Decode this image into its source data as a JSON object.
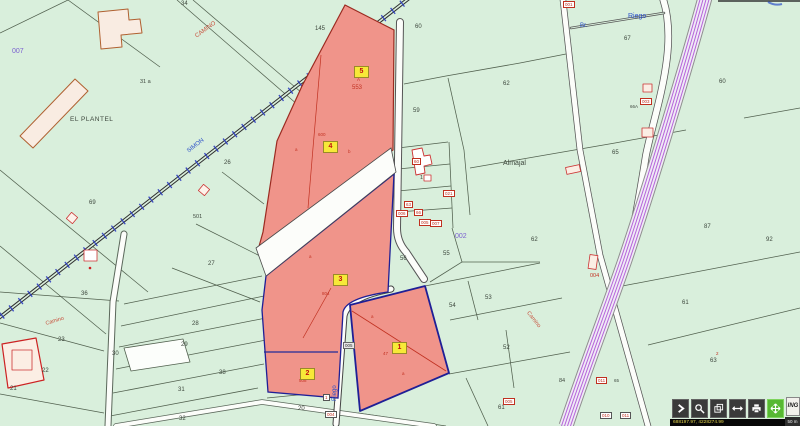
{
  "map": {
    "bg_color": "#d9efdc",
    "selected_fill": "#f0948a",
    "selection_outline": "#1f1f96",
    "texts": [
      {
        "name": "parcel-34",
        "t": "34",
        "x": 181,
        "y": 1,
        "c": "#3c463c",
        "s": 6
      },
      {
        "name": "parcel-145",
        "t": "145",
        "x": 315,
        "y": 26,
        "c": "#3c463c",
        "s": 6
      },
      {
        "name": "road-camino-top",
        "t": "CAMINO",
        "x": 196,
        "y": 34,
        "c": "#c8503c",
        "s": 6,
        "r": -36
      },
      {
        "name": "sheet-007",
        "t": "007",
        "x": 12,
        "y": 48,
        "c": "#7a5fd0",
        "s": 7
      },
      {
        "name": "place-el-plantel",
        "t": "EL PLANTEL",
        "x": 70,
        "y": 117,
        "c": "#3c463c",
        "s": 6.5,
        "ls": 0.5
      },
      {
        "name": "parcel-31a",
        "t": "31  a",
        "x": 140,
        "y": 80,
        "c": "#3c463c",
        "s": 5.5
      },
      {
        "name": "railway-simon",
        "t": "SIMON",
        "x": 188,
        "y": 149,
        "c": "#2b50c8",
        "s": 6,
        "r": -38
      },
      {
        "name": "parcel-60",
        "t": "60",
        "x": 415,
        "y": 24,
        "c": "#3c463c",
        "s": 6
      },
      {
        "name": "parcel-67",
        "t": "67",
        "x": 624,
        "y": 36,
        "c": "#3c463c",
        "s": 6
      },
      {
        "name": "riego-top",
        "t": "Riego",
        "x": 628,
        "y": 13,
        "c": "#2b50c8",
        "s": 7
      },
      {
        "name": "br-label",
        "t": "Br.",
        "x": 580,
        "y": 23,
        "c": "#2b50c8",
        "s": 6
      },
      {
        "name": "parcel-62",
        "t": "62",
        "x": 503,
        "y": 81,
        "c": "#3c463c",
        "s": 6
      },
      {
        "name": "parcel-59",
        "t": "59",
        "x": 413,
        "y": 108,
        "c": "#3c463c",
        "s": 6
      },
      {
        "name": "parcel-60b",
        "t": "60",
        "x": 719,
        "y": 79,
        "c": "#3c463c",
        "s": 6
      },
      {
        "name": "parcel-65",
        "t": "65",
        "x": 612,
        "y": 150,
        "c": "#3c463c",
        "s": 6
      },
      {
        "name": "place-almajal",
        "t": "Almajal",
        "x": 503,
        "y": 160,
        "c": "#3c463c",
        "s": 7
      },
      {
        "name": "sheet-002",
        "t": "002",
        "x": 455,
        "y": 233,
        "c": "#7a5fd0",
        "s": 7
      },
      {
        "name": "parcel-69",
        "t": "69",
        "x": 89,
        "y": 200,
        "c": "#3c463c",
        "s": 6
      },
      {
        "name": "parcel-26",
        "t": "26",
        "x": 224,
        "y": 160,
        "c": "#3c463c",
        "s": 6
      },
      {
        "name": "ref-501",
        "t": "501",
        "x": 193,
        "y": 215,
        "c": "#3c463c",
        "s": 5.5
      },
      {
        "name": "parcel-27",
        "t": "27",
        "x": 208,
        "y": 261,
        "c": "#3c463c",
        "s": 6
      },
      {
        "name": "ref-553",
        "t": "553",
        "x": 352,
        "y": 85,
        "c": "#c23222",
        "s": 6
      },
      {
        "name": "ref-a-top",
        "t": "A",
        "x": 357,
        "y": 78,
        "c": "#c23222",
        "s": 4.5
      },
      {
        "name": "ref-600",
        "t": "600",
        "x": 318,
        "y": 133,
        "c": "#c23222",
        "s": 4.5
      },
      {
        "name": "ref-804",
        "t": "804",
        "x": 322,
        "y": 292,
        "c": "#c23222",
        "s": 4.5
      },
      {
        "name": "ref-508",
        "t": "508",
        "x": 299,
        "y": 379,
        "c": "#c23222",
        "s": 4.5
      },
      {
        "name": "ref-47",
        "t": "47",
        "x": 383,
        "y": 352,
        "c": "#c23222",
        "s": 4.5
      },
      {
        "name": "parcel-56",
        "t": "56",
        "x": 400,
        "y": 256,
        "c": "#3c463c",
        "s": 6
      },
      {
        "name": "parcel-55",
        "t": "55",
        "x": 443,
        "y": 251,
        "c": "#3c463c",
        "s": 6
      },
      {
        "name": "parcel-62b",
        "t": "62",
        "x": 531,
        "y": 237,
        "c": "#3c463c",
        "s": 6
      },
      {
        "name": "parcel-87",
        "t": "87",
        "x": 704,
        "y": 224,
        "c": "#3c463c",
        "s": 6
      },
      {
        "name": "parcel-92",
        "t": "92",
        "x": 766,
        "y": 237,
        "c": "#3c463c",
        "s": 6
      },
      {
        "name": "ref-004",
        "t": "004",
        "x": 590,
        "y": 274,
        "c": "#c23222",
        "s": 5.5
      },
      {
        "name": "parcel-36",
        "t": "36",
        "x": 81,
        "y": 291,
        "c": "#3c463c",
        "s": 6
      },
      {
        "name": "parcel-28",
        "t": "28",
        "x": 192,
        "y": 321,
        "c": "#3c463c",
        "s": 6
      },
      {
        "name": "parcel-29",
        "t": "29",
        "x": 181,
        "y": 342,
        "c": "#3c463c",
        "s": 6
      },
      {
        "name": "parcel-30",
        "t": "30",
        "x": 112,
        "y": 351,
        "c": "#3c463c",
        "s": 6
      },
      {
        "name": "parcel-23",
        "t": "23",
        "x": 58,
        "y": 337,
        "c": "#3c463c",
        "s": 6
      },
      {
        "name": "parcel-22",
        "t": "22",
        "x": 42,
        "y": 368,
        "c": "#3c463c",
        "s": 6
      },
      {
        "name": "parcel-38",
        "t": "38",
        "x": 219,
        "y": 370,
        "c": "#3c463c",
        "s": 6
      },
      {
        "name": "parcel-31b",
        "t": "31",
        "x": 178,
        "y": 387,
        "c": "#3c463c",
        "s": 6
      },
      {
        "name": "parcel-21",
        "t": "21",
        "x": 10,
        "y": 386,
        "c": "#3c463c",
        "s": 6
      },
      {
        "name": "parcel-32",
        "t": "32",
        "x": 179,
        "y": 416,
        "c": "#3c463c",
        "s": 6
      },
      {
        "name": "parcel-20",
        "t": "20",
        "x": 298,
        "y": 406,
        "c": "#3c463c",
        "s": 6
      },
      {
        "name": "road-camino-left",
        "t": "Camino",
        "x": 46,
        "y": 322,
        "c": "#c8503c",
        "s": 5.5,
        "r": -17
      },
      {
        "name": "parcel-54",
        "t": "54",
        "x": 449,
        "y": 303,
        "c": "#3c463c",
        "s": 6
      },
      {
        "name": "parcel-53",
        "t": "53",
        "x": 485,
        "y": 295,
        "c": "#3c463c",
        "s": 6
      },
      {
        "name": "parcel-52",
        "t": "52",
        "x": 503,
        "y": 345,
        "c": "#3c463c",
        "s": 6
      },
      {
        "name": "parcel-61",
        "t": "61",
        "x": 682,
        "y": 300,
        "c": "#3c463c",
        "s": 6
      },
      {
        "name": "parcel-63",
        "t": "63",
        "x": 710,
        "y": 358,
        "c": "#3c463c",
        "s": 6
      },
      {
        "name": "parcel-61b",
        "t": "61",
        "x": 498,
        "y": 405,
        "c": "#3c463c",
        "s": 6
      },
      {
        "name": "parcel-84",
        "t": "84",
        "x": 559,
        "y": 379,
        "c": "#3c463c",
        "s": 5.5
      },
      {
        "name": "riego-vertical",
        "t": "Riego",
        "x": 335,
        "y": 398,
        "c": "#2b50c8",
        "s": 6,
        "r": -90
      },
      {
        "name": "road-camino-right",
        "t": "Camino",
        "x": 527,
        "y": 310,
        "c": "#c8503c",
        "s": 5.5,
        "r": 52
      },
      {
        "name": "ref-66a",
        "t": "66A",
        "x": 630,
        "y": 105,
        "c": "#3c463c",
        "s": 4.5
      },
      {
        "name": "ref-1-cluster",
        "t": "1",
        "x": 420,
        "y": 176,
        "c": "#3c463c",
        "s": 5.5
      },
      {
        "name": "ref-a1",
        "t": "a",
        "x": 295,
        "y": 148,
        "c": "#c23222",
        "s": 4.5
      },
      {
        "name": "ref-b1",
        "t": "b",
        "x": 348,
        "y": 150,
        "c": "#c23222",
        "s": 4.5
      },
      {
        "name": "ref-a2",
        "t": "a",
        "x": 309,
        "y": 255,
        "c": "#c23222",
        "s": 4.5
      },
      {
        "name": "ref-a3",
        "t": "a",
        "x": 371,
        "y": 315,
        "c": "#c23222",
        "s": 4.5
      },
      {
        "name": "ref-a4",
        "t": "a",
        "x": 402,
        "y": 372,
        "c": "#c23222",
        "s": 4.5
      },
      {
        "name": "ref-2r",
        "t": "2",
        "x": 716,
        "y": 352,
        "c": "#c23222",
        "s": 4.5
      },
      {
        "name": "ref-65b",
        "t": "65",
        "x": 614,
        "y": 379,
        "c": "#3c463c",
        "s": 4.5
      }
    ],
    "small_boxes": [
      {
        "t": "001",
        "x": 563,
        "y": 1,
        "style": "red-box"
      },
      {
        "t": "003",
        "x": 640,
        "y": 98,
        "style": "red-box"
      },
      {
        "t": "60",
        "x": 412,
        "y": 158,
        "style": "red-box"
      },
      {
        "t": "021",
        "x": 443,
        "y": 190,
        "style": "red-box"
      },
      {
        "t": "63",
        "x": 404,
        "y": 201,
        "style": "red-box"
      },
      {
        "t": "006",
        "x": 396,
        "y": 210,
        "style": "red-box"
      },
      {
        "t": "66",
        "x": 414,
        "y": 209,
        "style": "red-box"
      },
      {
        "t": "005",
        "x": 419,
        "y": 219,
        "style": "red-box"
      },
      {
        "t": "007",
        "x": 430,
        "y": 220,
        "style": "red-box"
      },
      {
        "t": "005",
        "x": 343,
        "y": 342,
        "style": "gray-box"
      },
      {
        "t": "1",
        "x": 323,
        "y": 394,
        "style": "white-box"
      },
      {
        "t": "004",
        "x": 325,
        "y": 411,
        "style": "white-box"
      },
      {
        "t": "005",
        "x": 503,
        "y": 398,
        "style": "red-box"
      },
      {
        "t": "011",
        "x": 596,
        "y": 377,
        "style": "red-box"
      },
      {
        "t": "010",
        "x": 600,
        "y": 412,
        "style": "white-box"
      },
      {
        "t": "011",
        "x": 620,
        "y": 412,
        "style": "white-box"
      }
    ],
    "badges": [
      {
        "n": "5",
        "x": 354,
        "y": 66
      },
      {
        "n": "4",
        "x": 323,
        "y": 141
      },
      {
        "n": "3",
        "x": 333,
        "y": 274
      },
      {
        "n": "2",
        "x": 300,
        "y": 368
      },
      {
        "n": "1",
        "x": 392,
        "y": 342
      }
    ]
  },
  "toolbar": {
    "buttons": [
      {
        "name": "expand",
        "glyph": "chevron",
        "active": false
      },
      {
        "name": "zoom",
        "glyph": "magnifier",
        "active": false
      },
      {
        "name": "layers",
        "glyph": "layers",
        "active": false
      },
      {
        "name": "measure",
        "glyph": "arrows-h",
        "active": false
      },
      {
        "name": "print",
        "glyph": "printer",
        "active": false
      },
      {
        "name": "pan",
        "glyph": "pan",
        "active": true
      }
    ],
    "ing_label": "ING",
    "coordinates": "688197.97, 4228274.99",
    "scale_label": "50 m"
  }
}
